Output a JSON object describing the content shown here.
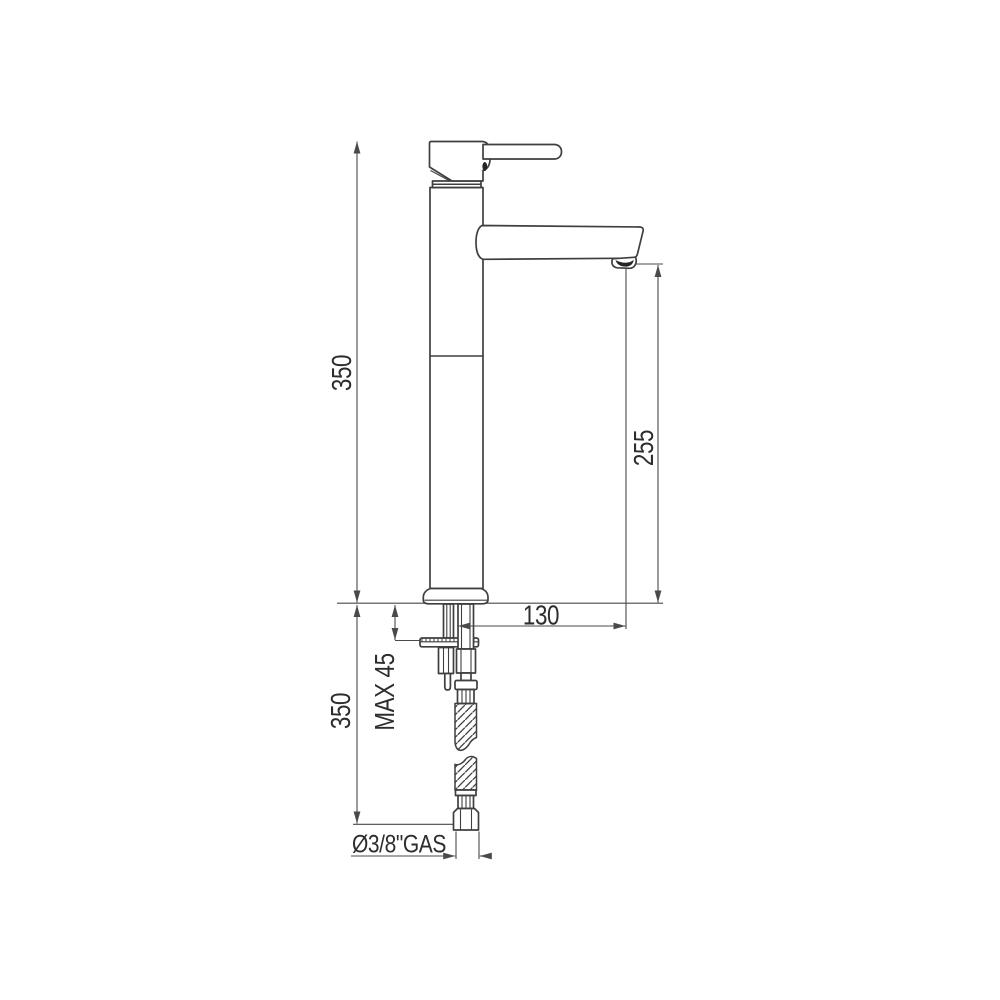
{
  "page": {
    "background": "#ffffff"
  },
  "drawing": {
    "type": "technical-drawing",
    "subject": "Tall single-lever basin mixer tap, side elevation with installation dimensions",
    "geometry_color": "#3f3f3f",
    "dimension_color": "#4a4a4a",
    "labels": {
      "total_height": "350",
      "spout_outlet_height": "255",
      "spout_reach": "130",
      "max_deck_thickness": "MAX 45",
      "hose_length": "350",
      "supply_thread": "Ø3/8\"GAS"
    }
  }
}
